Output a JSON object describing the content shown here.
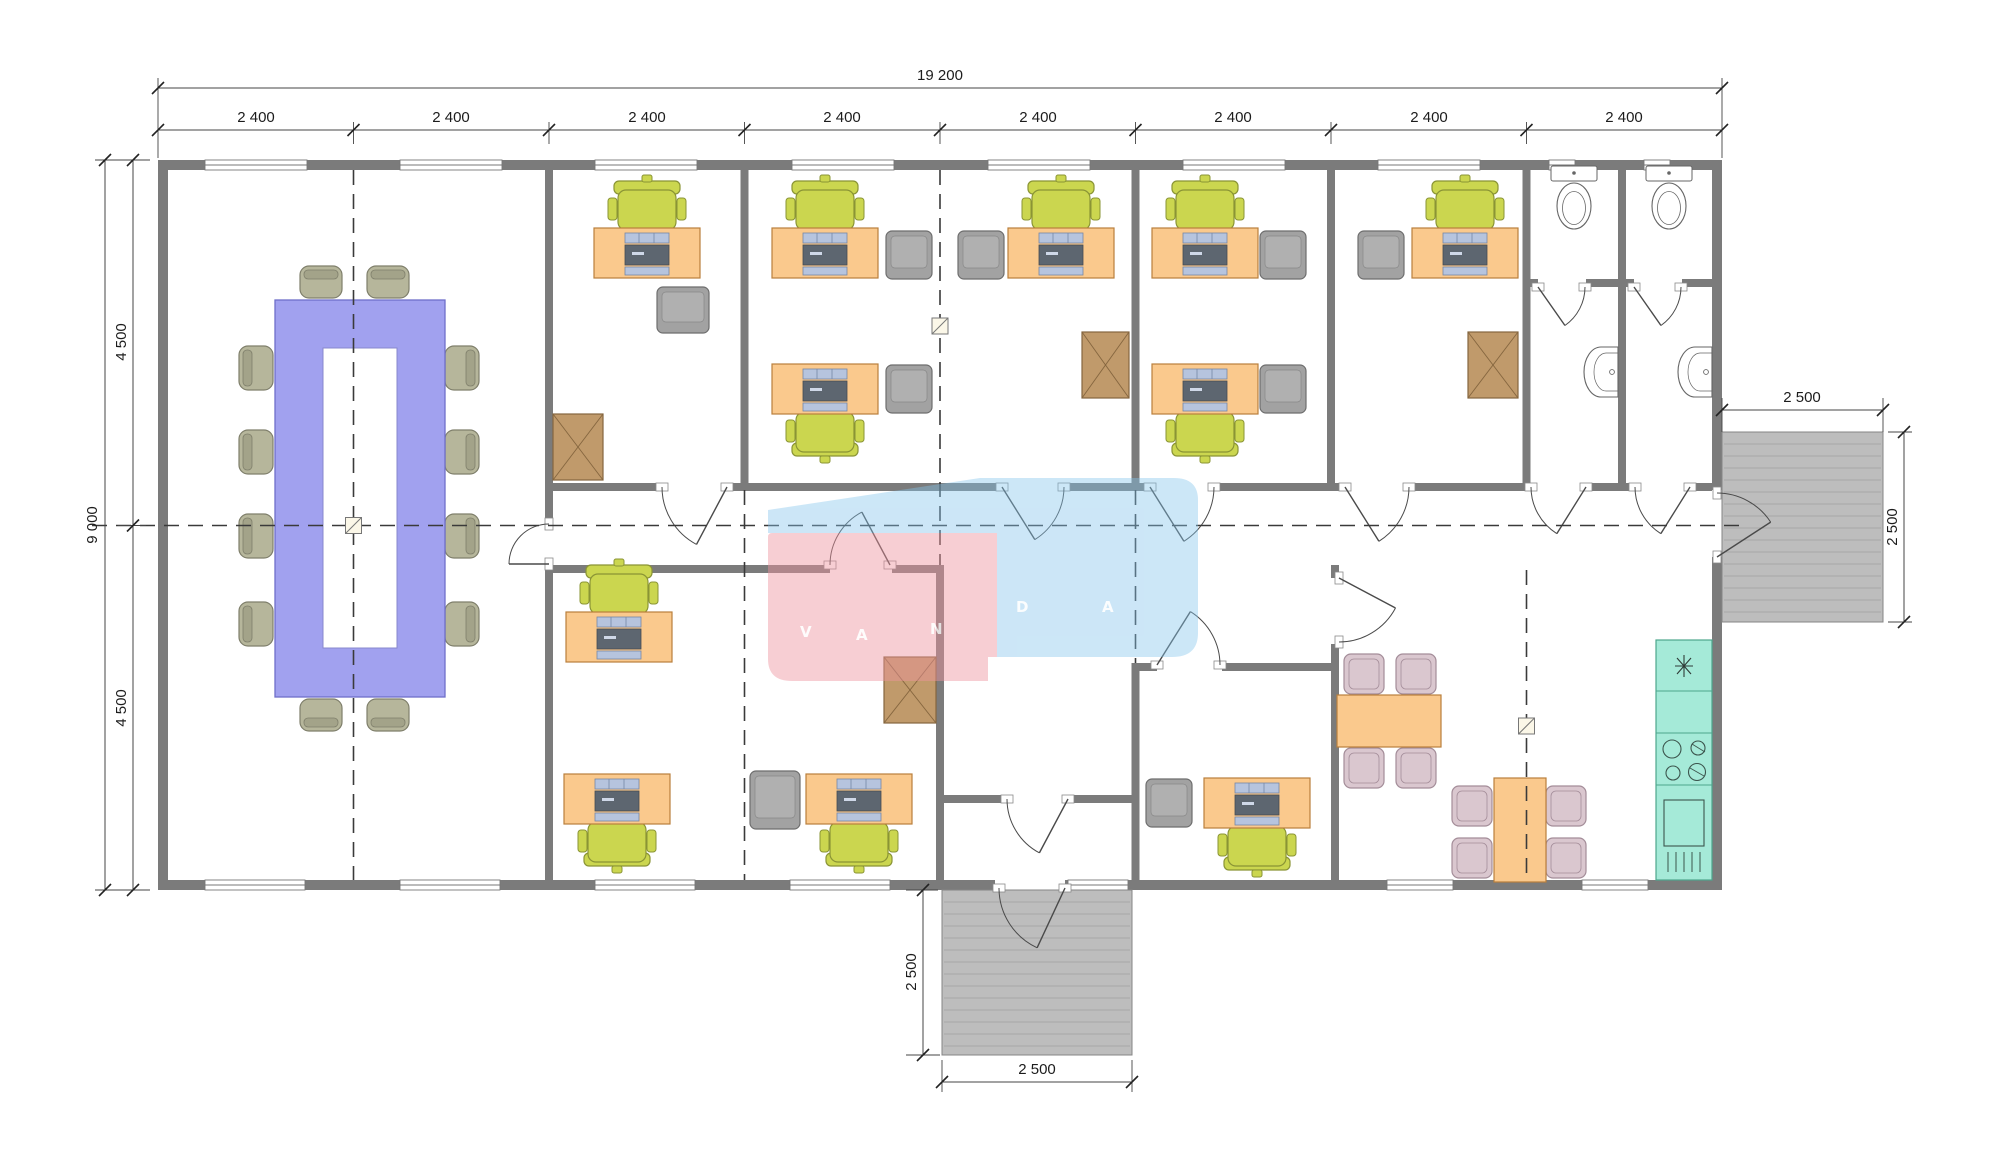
{
  "watermark": {
    "text": "VANDA",
    "letters": [
      "V",
      "A",
      "N",
      "D",
      "A"
    ],
    "pink_color": "#ee949e",
    "blue_color": "#84c4eb"
  },
  "dimensions": {
    "total_width": "19 200",
    "bays": [
      "2 400",
      "2 400",
      "2 400",
      "2 400",
      "2 400",
      "2 400",
      "2 400",
      "2 400"
    ],
    "total_height": "9 000",
    "left_upper": "4 500",
    "left_lower": "4 500",
    "right_porch_width": "2 500",
    "right_porch_depth": "2 500",
    "bottom_porch_depth": "2 500",
    "bottom_porch_width": "2 500"
  },
  "palette": {
    "wall": "#7b7b7b",
    "desk": "#fac98d",
    "task_chair": "#cbd64f",
    "guest_chair": "#a2a2a2",
    "conference_table": "#a1a1ef",
    "conference_chair": "#b6b69b",
    "dining_chair": "#dac7cf",
    "cabinet": "#c09a6b",
    "kitchen_counter": "#a5ead8",
    "deck": "#bdbdbd"
  }
}
